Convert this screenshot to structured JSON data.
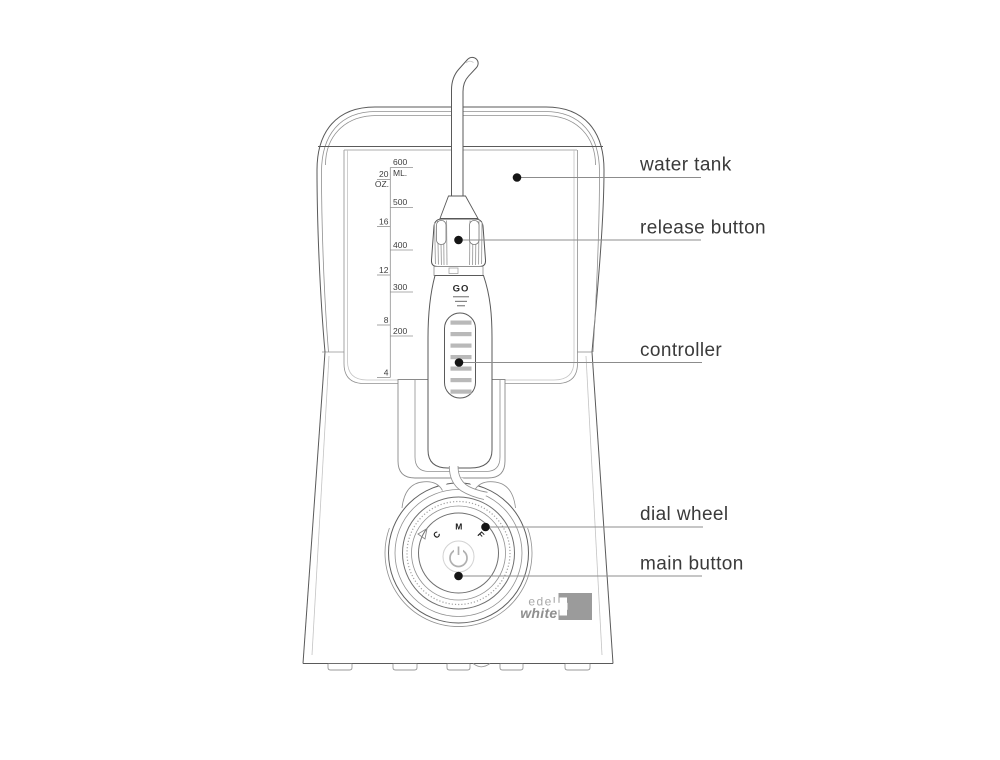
{
  "labels": {
    "water_tank": "water tank",
    "release_button": "release button",
    "controller": "controller",
    "dial_wheel": "dial wheel",
    "main_button": "main button"
  },
  "tank_scale": {
    "ml_values": [
      "600",
      "500",
      "400",
      "300",
      "200"
    ],
    "ml_unit": "ML.",
    "oz_values": [
      "20",
      "16",
      "12",
      "8",
      "4"
    ],
    "oz_unit": "OZ."
  },
  "handle": {
    "go": "GO"
  },
  "dial": {
    "letters": [
      "C",
      "M",
      "F"
    ]
  },
  "logo": {
    "line1": "edel",
    "line2": "white"
  },
  "colors": {
    "background": "#ffffff",
    "line": "#5a5a5a",
    "faint_line": "#c4c4c4",
    "leader_line": "#8c8c8c",
    "label_text": "#3a3a3a",
    "rib_gray": "#b9b9b9",
    "logo_gray": "#9b9b9b",
    "dot": "#151515"
  }
}
